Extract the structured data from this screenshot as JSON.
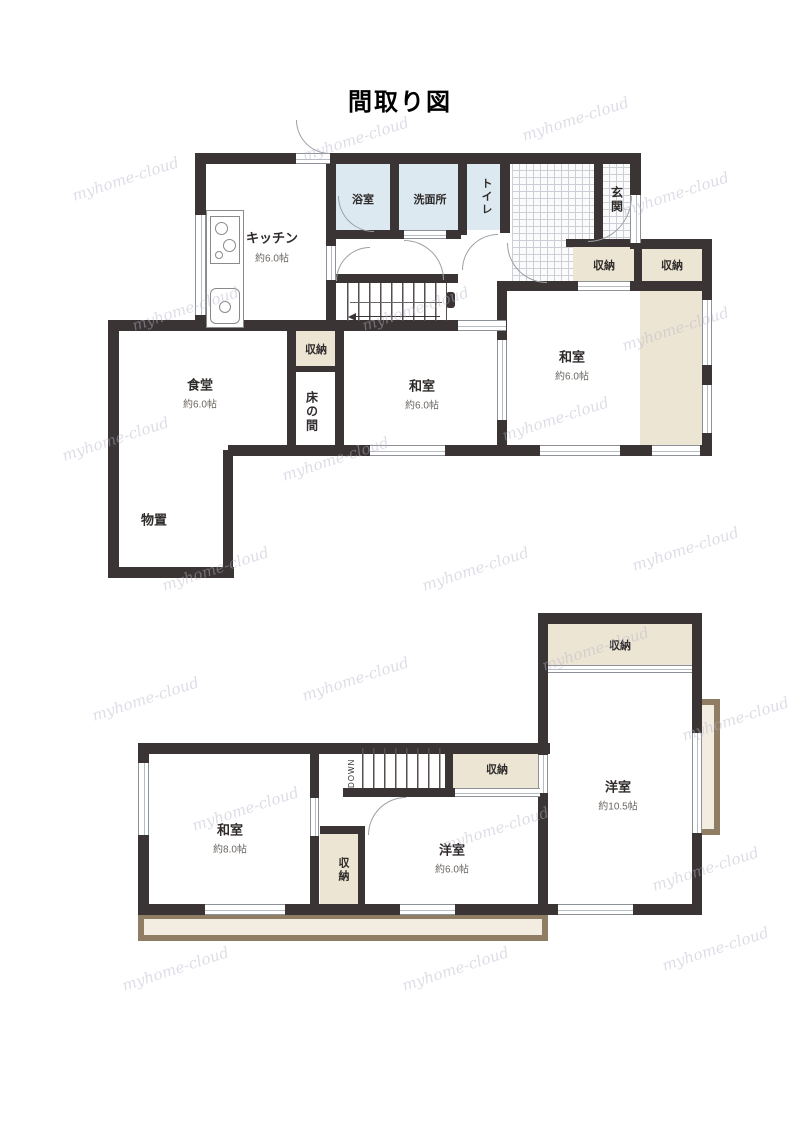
{
  "title": "間取り図",
  "watermark": "myhome-cloud",
  "colors": {
    "wall": "#3a3534",
    "storage_fill": "#ece5d3",
    "water_room_fill": "#dde9f1",
    "balcony_border": "#8f7d64",
    "balcony_fill": "#f2ede0"
  },
  "floor1": {
    "kitchen": {
      "name": "キッチン",
      "size": "約6.0帖"
    },
    "bath": {
      "name": "浴室"
    },
    "washroom": {
      "name": "洗面所"
    },
    "toilet": {
      "name": "トイレ"
    },
    "entrance": {
      "name": "玄関"
    },
    "storage_hall": {
      "name": "収納"
    },
    "storage_east": {
      "name": "収納"
    },
    "storage_mid": {
      "name": "収納"
    },
    "tokonoma": {
      "name": "床の間"
    },
    "washitsu_center": {
      "name": "和室",
      "size": "約6.0帖"
    },
    "washitsu_east": {
      "name": "和室",
      "size": "約6.0帖"
    },
    "dining": {
      "name": "食堂",
      "size": "約6.0帖"
    },
    "storeroom": {
      "name": "物置"
    }
  },
  "floor2": {
    "stairs": {
      "label": "DOWN"
    },
    "storage_by_stairs": {
      "name": "収納"
    },
    "storage_small": {
      "name": "収納"
    },
    "storage_top": {
      "name": "収納"
    },
    "washitsu": {
      "name": "和室",
      "size": "約8.0帖"
    },
    "youshitsu_center": {
      "name": "洋室",
      "size": "約6.0帖"
    },
    "youshitsu_east": {
      "name": "洋室",
      "size": "約10.5帖"
    }
  }
}
